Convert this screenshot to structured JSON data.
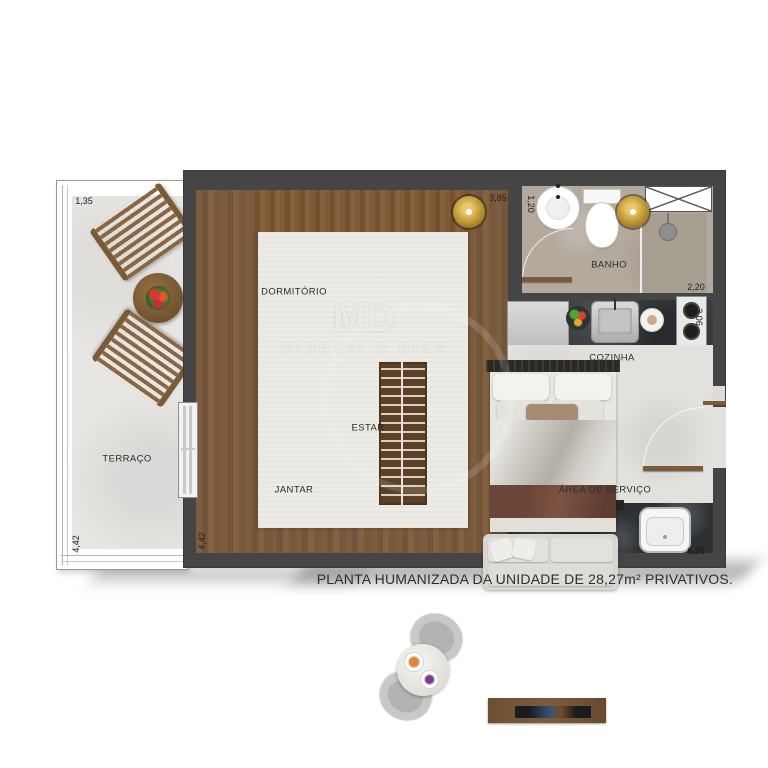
{
  "caption": "PLANTA HUMANIZADA DA UNIDADE DE 28,27m² PRIVATIVOS.",
  "watermark": {
    "monogram": "MD",
    "name": "MINGATI & DIAS"
  },
  "rooms": {
    "terraco": "TERRAÇO",
    "dormitorio": "DORMITÓRIO",
    "estar": "ESTAR",
    "jantar": "JANTAR",
    "banho": "BANHO",
    "cozinha": "COZINHA",
    "area_servico": "ÁREA DE SERVIÇO"
  },
  "dimensions": {
    "terrace_width": "1,35",
    "terrace_length": "4,42",
    "living_length": "4,42",
    "bedroom_width": "3,85",
    "bath_width": "1,20",
    "bath_length": "2,20",
    "kitchen_depth": "3,06",
    "unit_length": "6,20"
  },
  "colors": {
    "wall": "#454545",
    "wood_floor": "#7a5a3d",
    "rug": "#edebe5",
    "terrace_floor": "#e7e6e3",
    "bath_floor": "#b3a99d",
    "kitchen_counter": "#3a3d40",
    "stone_counter": "#2e3134",
    "pendant_gold": "#c9a03c"
  }
}
